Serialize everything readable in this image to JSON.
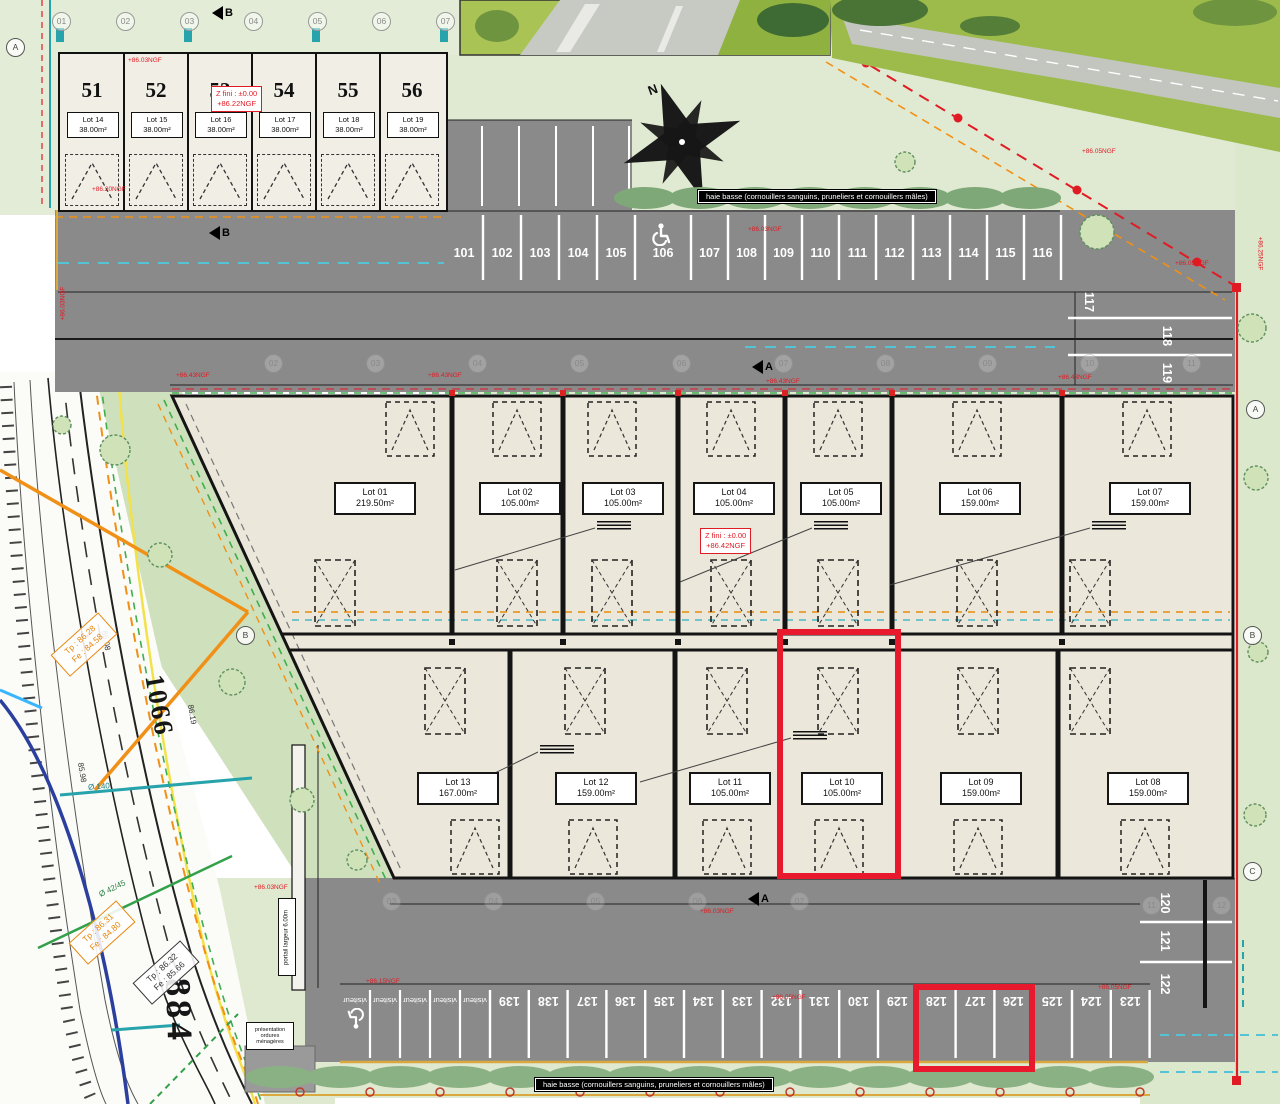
{
  "colors": {
    "asphalt": "#8a8a8a",
    "cream": "#ebe7da",
    "pale_green": "#e0ead2",
    "hedge": "#7fa878",
    "red": "#e11b23",
    "highlight": "#e8192c",
    "teal": "#27a3ab",
    "orange_util": "#f09016",
    "ochre": "#d9a93f",
    "yellow": "#f3e14a",
    "blue": "#2b3f9e",
    "green_util": "#33a04a"
  },
  "top_units": {
    "numbers": [
      "51",
      "52",
      "53",
      "54",
      "55",
      "56"
    ],
    "lots": [
      "Lot 14",
      "Lot 15",
      "Lot 16",
      "Lot 17",
      "Lot 18",
      "Lot 19"
    ],
    "areas": [
      "38.00m²",
      "38.00m²",
      "38.00m²",
      "38.00m²",
      "38.00m²",
      "38.00m²"
    ]
  },
  "z_top": {
    "line1": "Z fini : ±0.00",
    "line2": "+86.22NGF"
  },
  "z_main": {
    "line1": "Z fini : ±0.00",
    "line2": "+86.42NGF"
  },
  "grid_bubbles_top": [
    "01",
    "02",
    "03",
    "04",
    "05",
    "06",
    "07"
  ],
  "building_axes": [
    "02",
    "03",
    "04",
    "05",
    "06",
    "07",
    "08",
    "09",
    "10",
    "11"
  ],
  "bottom_axes": [
    "03",
    "04",
    "05",
    "06",
    "07"
  ],
  "bottom_axes_right": [
    "11",
    "12"
  ],
  "markers": {
    "a": "A",
    "b": "B"
  },
  "grid_letters": {
    "a": "A",
    "b": "B",
    "c": "C"
  },
  "parking": {
    "top_row": [
      "101",
      "102",
      "103",
      "104",
      "105",
      "106",
      "107",
      "108",
      "109",
      "110",
      "111",
      "112",
      "113",
      "114",
      "115",
      "116"
    ],
    "right_upper": [
      "117",
      "118",
      "119"
    ],
    "right_lower": [
      "120",
      "121",
      "122"
    ],
    "bottom_row": [
      "139",
      "138",
      "137",
      "136",
      "135",
      "134",
      "133",
      "132",
      "131",
      "130",
      "129",
      "128",
      "127",
      "126",
      "125",
      "124",
      "123"
    ],
    "visitor_label": "visiteur",
    "visitor_count": 5
  },
  "building": {
    "top_lots": [
      {
        "name": "Lot 01",
        "area": "219.50m²"
      },
      {
        "name": "Lot 02",
        "area": "105.00m²"
      },
      {
        "name": "Lot 03",
        "area": "105.00m²"
      },
      {
        "name": "Lot 04",
        "area": "105.00m²"
      },
      {
        "name": "Lot 05",
        "area": "105.00m²"
      },
      {
        "name": "Lot 06",
        "area": "159.00m²"
      },
      {
        "name": "Lot 07",
        "area": "159.00m²"
      }
    ],
    "bottom_lots": [
      {
        "name": "Lot 13",
        "area": "167.00m²"
      },
      {
        "name": "Lot 12",
        "area": "159.00m²"
      },
      {
        "name": "Lot 11",
        "area": "105.00m²"
      },
      {
        "name": "Lot 10",
        "area": "105.00m²"
      },
      {
        "name": "Lot 09",
        "area": "159.00m²"
      },
      {
        "name": "Lot 08",
        "area": "159.00m²"
      }
    ]
  },
  "hedge_banner": "haie basse (cornouillers sanguins, pruneliers et cornouillers mâles)",
  "gate_label": "portail largeur 6.00m",
  "waste_label": "présentation ordures ménagères",
  "compass_label": "N",
  "road": {
    "street_number_1": "1066",
    "street_number_2": "884",
    "diamond_1": {
      "tp": "Tp : 86.28",
      "fe": "Fe : 84.58"
    },
    "diamond_2": {
      "tp": "Tp : 86.31",
      "fe": "Fe : 84.80"
    },
    "diamond_3": {
      "tp": "Tp : 86.32",
      "fe": "Fe : 85.66"
    },
    "pipe_label_1": "Ø 140",
    "pipe_label_2": "Ø 42/45",
    "spot_elevations": [
      {
        "t": "86.08",
        "x": 96,
        "y": 636,
        "r": 80
      },
      {
        "t": "86.19",
        "x": 182,
        "y": 710,
        "r": 80
      },
      {
        "t": "85.98",
        "x": 72,
        "y": 768,
        "r": 80
      }
    ]
  },
  "elevations": [
    {
      "t": "+86.03NGF",
      "x": 128,
      "y": 57,
      "r": 0
    },
    {
      "t": "+86.20NGF",
      "x": 92,
      "y": 186,
      "r": 0
    },
    {
      "t": "+86.05NGF",
      "x": 1082,
      "y": 148,
      "r": 0
    },
    {
      "t": "+86.03NGF",
      "x": 748,
      "y": 226,
      "r": 0
    },
    {
      "t": "+86.05NGF",
      "x": 1175,
      "y": 260,
      "r": 0
    },
    {
      "t": "+86.43NGF",
      "x": 176,
      "y": 372,
      "r": 0
    },
    {
      "t": "+86.43NGF",
      "x": 428,
      "y": 372,
      "r": 0
    },
    {
      "t": "+86.43NGF",
      "x": 766,
      "y": 378,
      "r": 0
    },
    {
      "t": "+86.43NGF",
      "x": 1058,
      "y": 374,
      "r": 0
    },
    {
      "t": "+86.25NGF",
      "x": 1243,
      "y": 250,
      "r": 90
    },
    {
      "t": "+86.03NGF",
      "x": 46,
      "y": 300,
      "r": -90
    },
    {
      "t": "+86.03NGF",
      "x": 254,
      "y": 884,
      "r": 0
    },
    {
      "t": "+86.03NGF",
      "x": 700,
      "y": 908,
      "r": 0
    },
    {
      "t": "+86.15NGF",
      "x": 366,
      "y": 978,
      "r": 0
    },
    {
      "t": "+86.05NGF",
      "x": 772,
      "y": 994,
      "r": 0
    },
    {
      "t": "+86.05NGF",
      "x": 1098,
      "y": 984,
      "r": 0
    }
  ]
}
